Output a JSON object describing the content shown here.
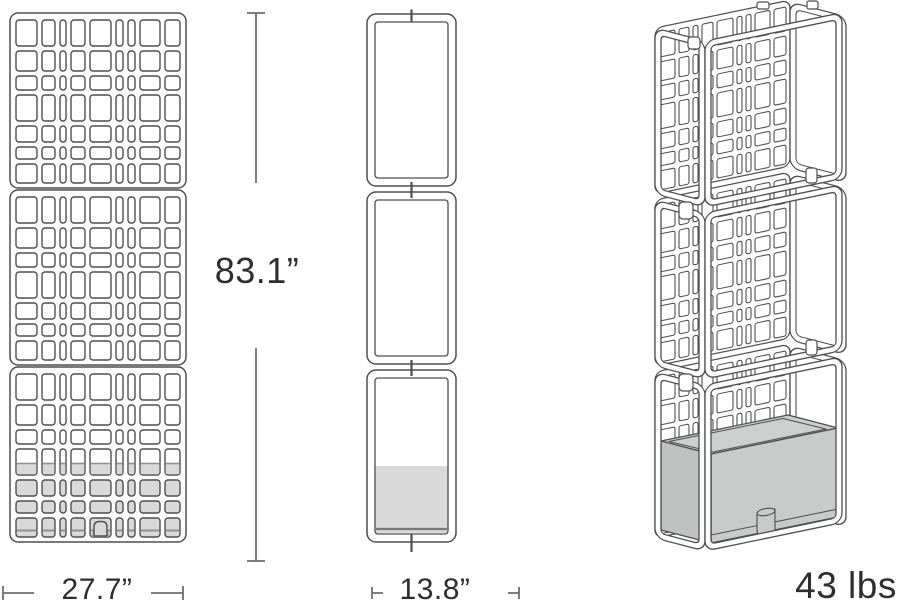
{
  "dimensions": {
    "height": "83.1”",
    "width": "27.7”",
    "depth": "13.8”",
    "weight": "43 lbs"
  },
  "colors": {
    "background": "#ffffff",
    "line": "#4f4f4f",
    "dim_line": "#6e6e6e",
    "label_text": "#2e2e2e",
    "planter_gray": "#d9d9d9",
    "planter_rim_line": "#8f8f8f",
    "planter_top": "#cccfce",
    "planter_front": "#c8cbca",
    "planter_side": "#bfc2c1"
  }
}
